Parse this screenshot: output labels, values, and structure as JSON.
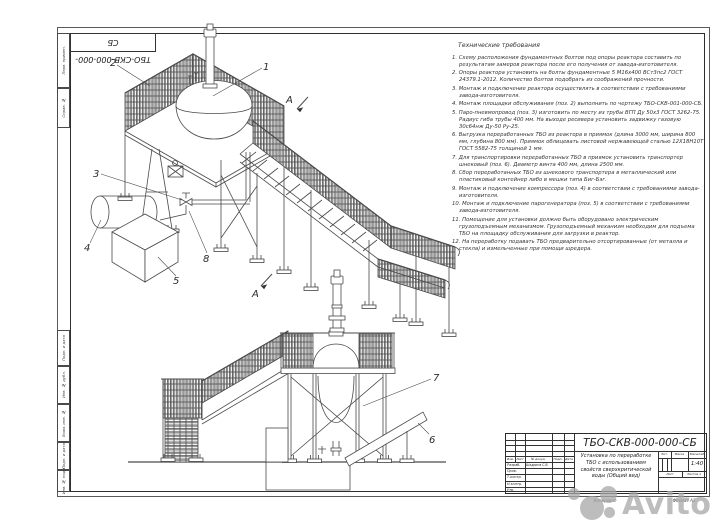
{
  "frame": {
    "designation_flipped": "ТБО-СКВ-000-000-СБ",
    "side_labels": [
      "Перв. примен.",
      "Справ. №",
      "Подп. и дата",
      "Инв. № дубл.",
      "Взам. инв. №",
      "Подп. и дата",
      "Инв. № подл."
    ]
  },
  "tech_requirements": {
    "title": "Технические требования",
    "items": [
      "1. Схему расположения фундаментных болтов под опоры реактора составить по результатам замеров реактора после его получения от завода-изготовителя.",
      "2. Опоры реактора установить на болты фундаментные 5 М16х400 ВСт3пс2 ГОСТ 24379.1-2012. Количество болтов подобрать из соображений прочности.",
      "3. Монтаж и подключение реактора осуществлять в соответствии с требованиями завода-изготовителя.",
      "4. Монтаж площадки обслуживания (поз. 2) выполнить по чертежу ТБО-СКВ-001-000-СБ.",
      "5. Паро-пневмопровод (поз. 3) изготовить по месту из трубы ВГП Ду 50х3 ГОСТ 3262-75. Радиус гиба трубы 400 мм. На выходе ресивера установить задвижку газовую 30с64нж Ду-50 Ру-25.",
      "6. Выгрузка переработанных ТБО из реактора в приямок (длина 3000 мм, ширина 800 мм, глубина 800 мм). Приямок облицевать листовой нержавеющей сталью 12Х18Н10Т ГОСТ 5582-75 толщиной 1 мм.",
      "7. Для транспортировки переработанных ТБО в приямок установить транспортер шнековый (поз. 6). Диаметр винта 400 мм, длина 2500 мм.",
      "8. Сбор переработанных ТБО из шнекового транспортера в металлический или пластиковый контейнер либо в мешки типа Биг-Бэг.",
      "9. Монтаж и подключение компрессора (поз. 4) в соответствии с требованиями завода-изготовителя.",
      "10. Монтаж и подключение парогенератора (поз. 5) в соответствии с требованиями завода-изготовителя.",
      "11. Помещение для установки должно быть оборудовано электрическим грузоподъемным механизмом. Грузоподъемный механизм необходим для подъема ТБО на площадку обслуживания для загрузки в реактор.",
      "12. На переработку подавать ТБО предварительно отсортированные (от металла и стекла) и измельченные при помощи шредера."
    ]
  },
  "views": {
    "section_letter": "А",
    "callouts": {
      "c1": "1",
      "c2": "2",
      "c3": "3",
      "c4": "4",
      "c5": "5",
      "c6": "6",
      "c7": "7",
      "c8": "8"
    }
  },
  "title_block": {
    "designation": "ТБО-СКВ-000-000-СБ",
    "doc_title": "Установка по переработке ТБО с использованием свойств сверхкритической воды (Общий вид)",
    "header_cols": [
      "Изм.",
      "Лист",
      "№ докум.",
      "Подп.",
      "Дата"
    ],
    "rows": [
      {
        "label": "Разраб.",
        "name": "Шадрина С.В."
      },
      {
        "label": "Пров.",
        "name": ""
      },
      {
        "label": "Т.контр.",
        "name": ""
      },
      {
        "label": "Н.контр.",
        "name": ""
      },
      {
        "label": "Утв.",
        "name": ""
      }
    ],
    "lit_label": "Лит.",
    "mass_label": "Масса",
    "scale_label": "Масштаб",
    "scale_value": "1:40",
    "sheet_label": "Лист",
    "sheets_label": "Листов",
    "sheets_value": "1"
  },
  "footer": {
    "copied": "Копировал",
    "format": "Формат А3"
  },
  "watermark": {
    "text": "Avito"
  }
}
